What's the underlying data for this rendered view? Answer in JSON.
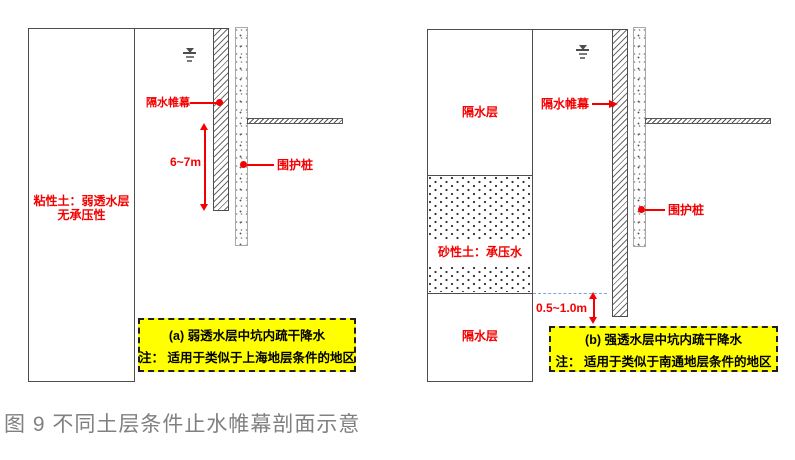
{
  "figure": {
    "caption": "图 9 不同土层条件止水帷幕剖面示意"
  },
  "colors": {
    "annotation_red": "#f40000",
    "note_background_yellow": "#ffff00",
    "caption_gray": "#808080",
    "water_level_dash_blue": "#7da7dc",
    "line_gray": "#4d4d4d"
  },
  "left": {
    "soil_label_line1": "粘性土：弱透水层",
    "soil_label_line2": "无承压性",
    "curtain_label": "隔水帷幕",
    "pile_label": "围护桩",
    "depth_label": "6~7m",
    "note_title": "(a) 弱透水层中坑内疏干降水",
    "note_text": "注： 适用于类似于上海地层条件的地区"
  },
  "right": {
    "top_layer_label": "隔水层",
    "middle_layer_label": "砂性土：承压水",
    "bottom_layer_label": "隔水层",
    "curtain_label": "隔水帷幕",
    "pile_label": "围护桩",
    "depth_label": "0.5~1.0m",
    "note_title": "(b)  强透水层中坑内疏干降水",
    "note_text": "注： 适用于类似于南通地层条件的地区"
  },
  "icons": {
    "water_table_icon": "groundwater level symbol (inverted triangle over lines)"
  }
}
